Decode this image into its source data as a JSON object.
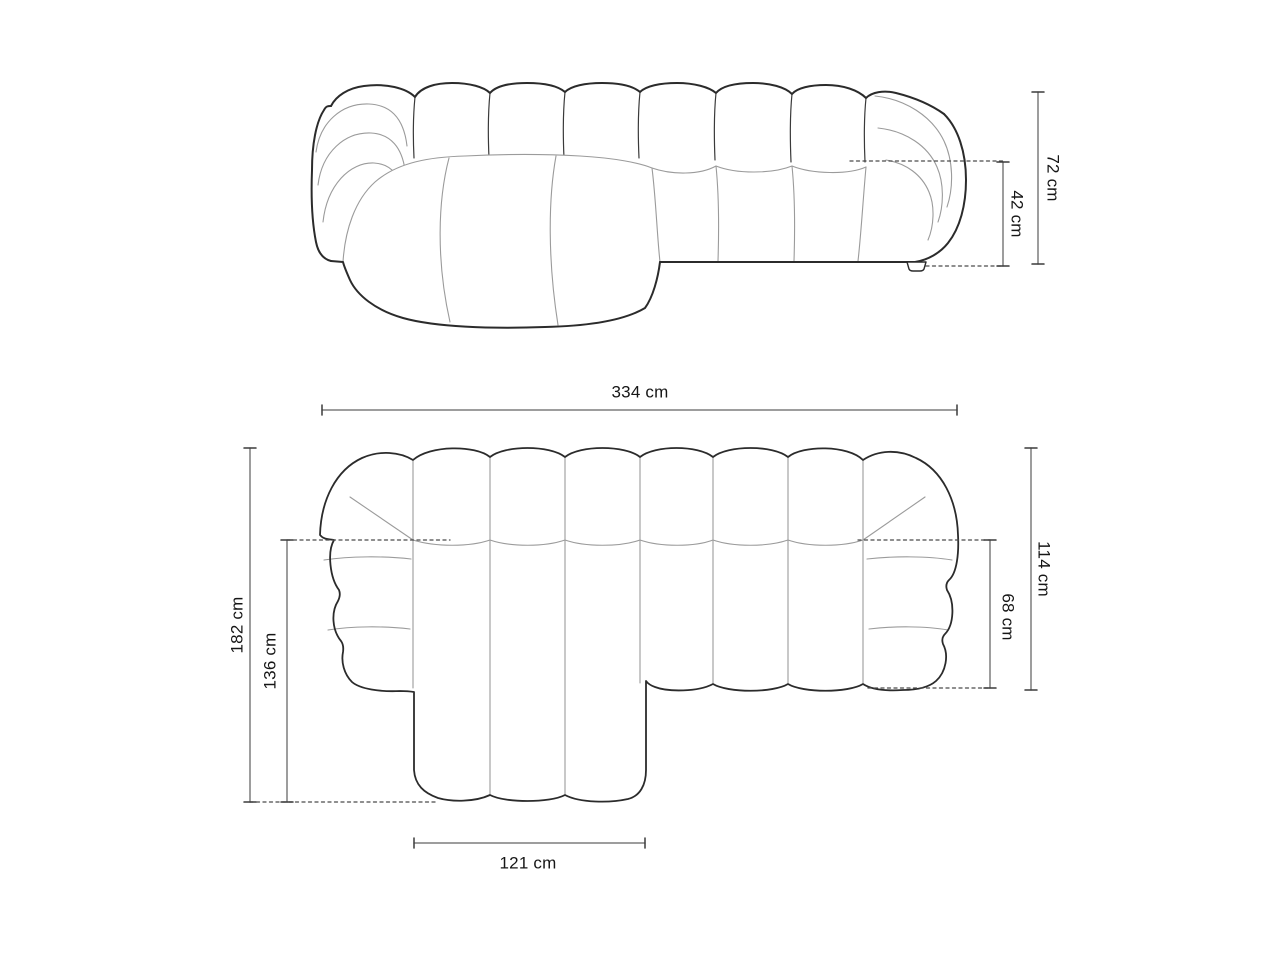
{
  "diagram": {
    "type": "furniture-dimension-drawing",
    "subject": "modular chaise sectional sofa",
    "unit": "cm",
    "views": {
      "front": {
        "name": "front-elevation"
      },
      "plan": {
        "name": "top-plan"
      }
    }
  },
  "dims": {
    "front_height": {
      "label": "72 cm",
      "value": 72
    },
    "front_seat_height": {
      "label": "42 cm",
      "value": 42
    },
    "plan_width": {
      "label": "334 cm",
      "value": 334
    },
    "plan_depth": {
      "label": "182 cm",
      "value": 182
    },
    "plan_chaise_depth": {
      "label": "136 cm",
      "value": 136
    },
    "plan_body_depth": {
      "label": "114 cm",
      "value": 114
    },
    "plan_seat_depth": {
      "label": "68 cm",
      "value": 68
    },
    "plan_chaise_width": {
      "label": "121 cm",
      "value": 121
    }
  },
  "colors": {
    "background": "#ffffff",
    "outline": "#2b2b2b",
    "seam": "#9b9b9b",
    "dimension_line": "#7d7d7d",
    "dimension_cap": "#3c3c3c",
    "dashed_line": "#4a4a4a",
    "text": "#161616"
  }
}
